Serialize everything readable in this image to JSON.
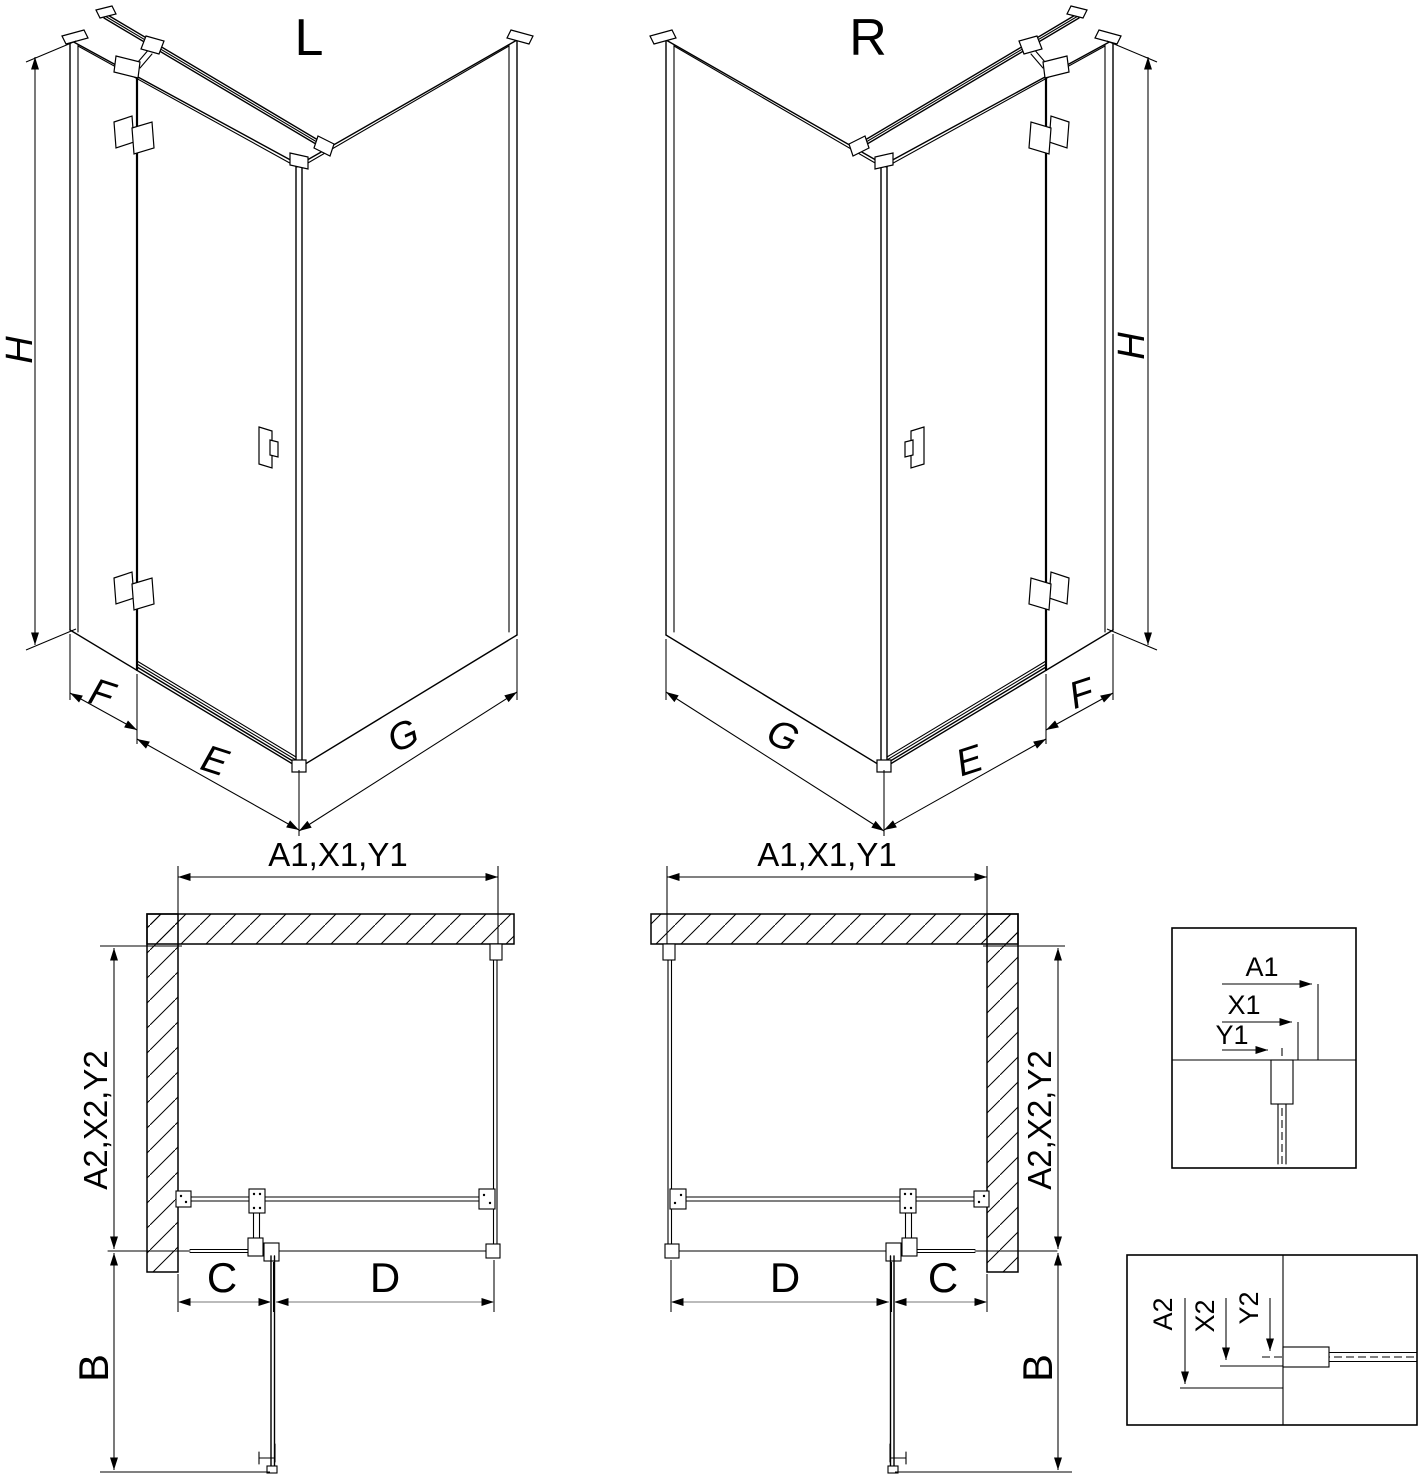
{
  "colors": {
    "line": "#000000",
    "background": "#ffffff",
    "dim_gray": "#777777"
  },
  "iso_left": {
    "title": "L",
    "dim_height": "H",
    "dim_fixed": "F",
    "dim_door": "E",
    "dim_return": "G"
  },
  "iso_right": {
    "title": "R",
    "dim_height": "H",
    "dim_fixed": "F",
    "dim_door": "E",
    "dim_return": "G"
  },
  "plan_left": {
    "dim_width": "A1,X1,Y1",
    "dim_depth": "A2,X2,Y2",
    "dim_fixed": "C",
    "dim_door": "D",
    "dim_door_open": "B"
  },
  "plan_right": {
    "dim_width": "A1,X1,Y1",
    "dim_depth": "A2,X2,Y2",
    "dim_fixed": "C",
    "dim_door": "D",
    "dim_door_open": "B"
  },
  "detail_width": {
    "a": "A1",
    "x": "X1",
    "y": "Y1"
  },
  "detail_depth": {
    "a": "A2",
    "x": "X2",
    "y": "Y2"
  }
}
